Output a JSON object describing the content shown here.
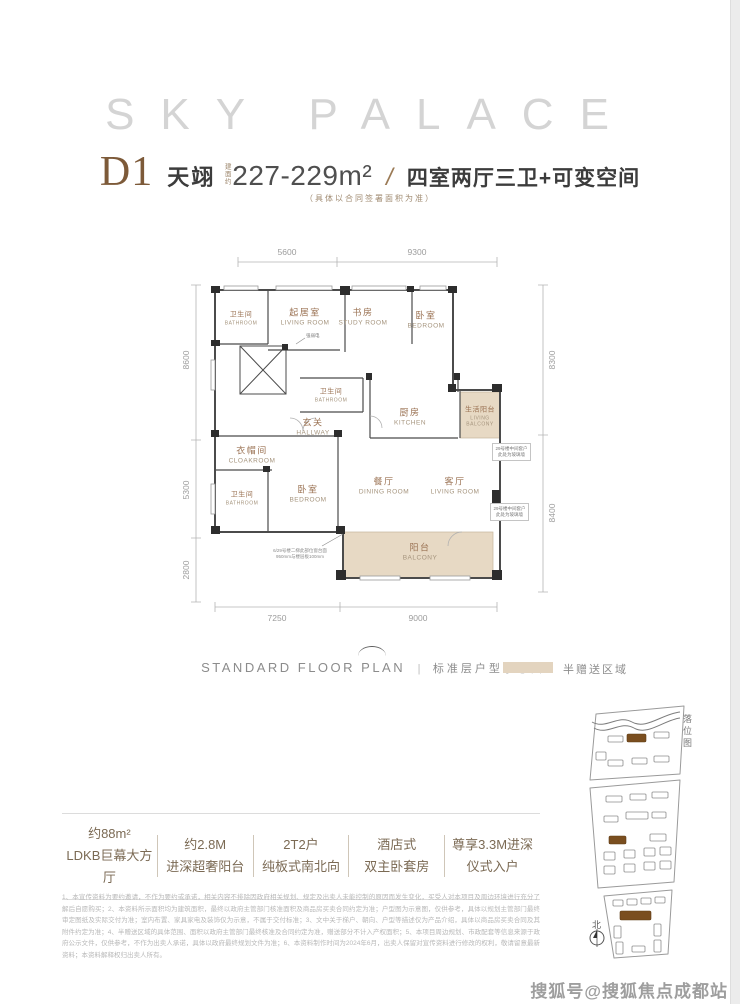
{
  "brand": {
    "title": "SKY PALACE"
  },
  "header": {
    "unit_code": "D1",
    "unit_name": "天翊",
    "area_prefix": "建面约",
    "area": "227-229m²",
    "separator": "/",
    "layout": "四室两厅三卫+可变空间",
    "note": "（具体以合同签署面积为准）"
  },
  "plan": {
    "dims": {
      "top": [
        "5600",
        "9300"
      ],
      "left": [
        "8600",
        "5300",
        "2800"
      ],
      "right": [
        "8300",
        "8400"
      ],
      "bottom": [
        "7250",
        "9000"
      ]
    },
    "rooms": [
      {
        "cn": "卫生间",
        "en": "BATHROOM"
      },
      {
        "cn": "起居室",
        "en": "LIVING ROOM"
      },
      {
        "cn": "书房",
        "en": "STUDY ROOM"
      },
      {
        "cn": "卧室",
        "en": "BEDROOM"
      },
      {
        "cn": "卫生间",
        "en": "BATHROOM"
      },
      {
        "cn": "玄关",
        "en": "HALLWAY"
      },
      {
        "cn": "厨房",
        "en": "KITCHEN"
      },
      {
        "cn": "生活阳台",
        "en": "LIVING BALCONY"
      },
      {
        "cn": "衣帽间",
        "en": "CLOAKROOM"
      },
      {
        "cn": "卫生间",
        "en": "BATHROOM"
      },
      {
        "cn": "卧室",
        "en": "BEDROOM"
      },
      {
        "cn": "餐厅",
        "en": "DINING ROOM"
      },
      {
        "cn": "客厅",
        "en": "LIVING ROOM"
      },
      {
        "cn": "阳台",
        "en": "BALCONY"
      }
    ],
    "annotations": {
      "shaft": "强弱电",
      "window_note_1": "6/29号楼二梯此部位窗台面",
      "window_note_2": "950mm与楼层板100mm",
      "side_note_1a": "29号楼中间套户",
      "side_note_1b": "此处为玻璃墙",
      "side_note_2a": "29号楼中间套户",
      "side_note_2b": "此处为玻璃墙"
    }
  },
  "caption": {
    "en": "STANDARD FLOOR PLAN",
    "divider": "|",
    "cn": "标准层户型示意图",
    "legend": "半赠送区域",
    "legend_color": "#e3d4bf"
  },
  "features": [
    {
      "line1": "约88m²",
      "line2": "LDKB巨幕大方厅"
    },
    {
      "line1": "约2.8M",
      "line2": "进深超奢阳台"
    },
    {
      "line1": "2T2户",
      "line2": "纯板式南北向"
    },
    {
      "line1": "酒店式",
      "line2": "双主卧套房"
    },
    {
      "line1": "尊享3.3M进深",
      "line2": "仪式入户"
    }
  ],
  "disclaimer": "1、本宣传资料为要约邀请，不作为要约或承诺，相关内容不排除因政府相关规划、规定及出卖人未能控制的原因而发生变化，买受人对本项目及周边环境进行充分了解后自愿购买；2、本资料所示面积均为建筑面积，最终以政府主管部门核准面积及商品房买卖合同约定为准；户型图为示意图，仅供参考，具体以规划主管部门最终审定图纸及实际交付为准；室内布置、家具家电及装饰仅为示意，不属于交付标准；3、文中关于梯户、朝向、户型等描述仅为产品介绍，具体以商品房买卖合同及其附件约定为准；4、半赠送区域的具体范围、面积以政府主管部门最终核准及合同约定为准，赠送部分不计入产权面积；5、本项目周边规划、市政配套等信息来源于政府公示文件，仅供参考，不作为出卖人承诺，具体以政府最终规划文件为准；6、本资料制作时间为2024年6月，出卖人保留对宣传资料进行修改的权利，敬请留意最新资料；本资料解释权归出卖人所有。",
  "site_plan": {
    "label": "落位图",
    "compass": "北"
  },
  "watermark": "搜狐号@搜狐焦点成都站",
  "colors": {
    "accent_brown": "#7d5a39",
    "room_label_brown": "#9b7354",
    "gift_area_beige": "#e7d9c4",
    "wall": "#4b4b4b",
    "caption_gray": "#8c8c8c"
  }
}
